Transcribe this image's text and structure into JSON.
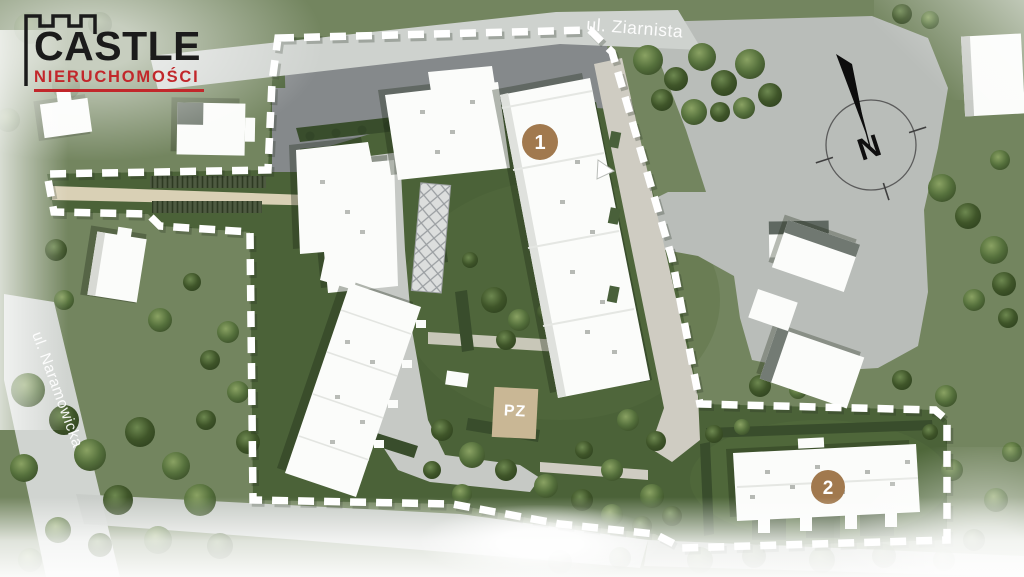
{
  "logo": {
    "line1": "CASTLE",
    "line2": "NIERUCHOMOŚCI"
  },
  "labels": {
    "street_top": "ul. Ziarnista",
    "street_left": "ul. Naramowicka",
    "compass_north": "N",
    "garage_entrance": "PZ"
  },
  "markers": [
    {
      "id": "building-1",
      "label": "1"
    },
    {
      "id": "building-2",
      "label": "2"
    }
  ],
  "colors": {
    "accent_brown": "#a1794e",
    "logo_red": "#c2272b",
    "logo_black": "#1b1b1b",
    "site_green": "#4b6238",
    "field_green": "#73855f",
    "road_gray": "#ced2ce",
    "parking_gray": "#b9bdb9",
    "asphalt_gray": "#85898b",
    "path_beige": "#d9d0b5",
    "pz_beige": "#c9b795",
    "building_white": "#fbfcfa",
    "boundary_white": "#ffffff"
  }
}
